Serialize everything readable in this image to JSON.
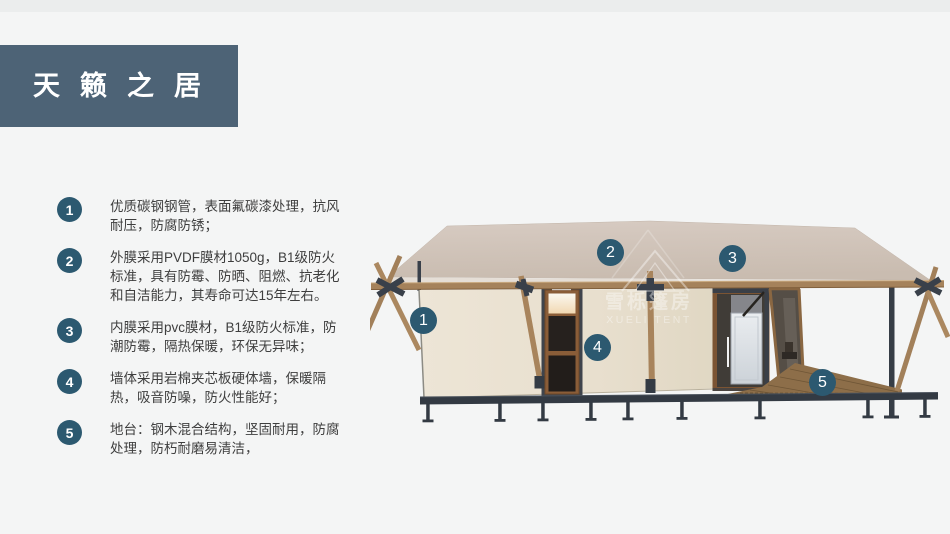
{
  "banner": {
    "title": "天籁之居",
    "bg_color": "#4d6376"
  },
  "features": [
    {
      "num": "1",
      "text": "优质碳钢钢管，表面氟碳漆处理，抗风耐压，防腐防锈；"
    },
    {
      "num": "2",
      "text": "外膜采用PVDF膜材1050g，B1级防火标准，具有防霉、防晒、阻燃、抗老化和自洁能力，其寿命可达15年左右。"
    },
    {
      "num": "3",
      "text": "内膜采用pvc膜材，B1级防火标准，防潮防霉，隔热保暖，环保无异味；"
    },
    {
      "num": "4",
      "text": "墙体采用岩棉夹芯板硬体墙，保暖隔热，吸音防噪，防火性能好；"
    },
    {
      "num": "5",
      "text": "地台：钢木混合结构，坚固耐用，防腐处理，防朽耐磨易清洁，"
    }
  ],
  "illustration": {
    "callouts": [
      {
        "label": "1"
      },
      {
        "label": "2"
      },
      {
        "label": "3"
      },
      {
        "label": "4"
      },
      {
        "label": "5"
      }
    ],
    "watermark": {
      "line1": "雪栎篷房",
      "line2": "XUELI TENT"
    },
    "colors": {
      "callout_circle": "#2c5970",
      "roof": "#d0c4ba",
      "wall": "#e9e1d1",
      "wood": "#a5825b",
      "steel": "#39404a",
      "deck": "#8d6e49"
    }
  }
}
